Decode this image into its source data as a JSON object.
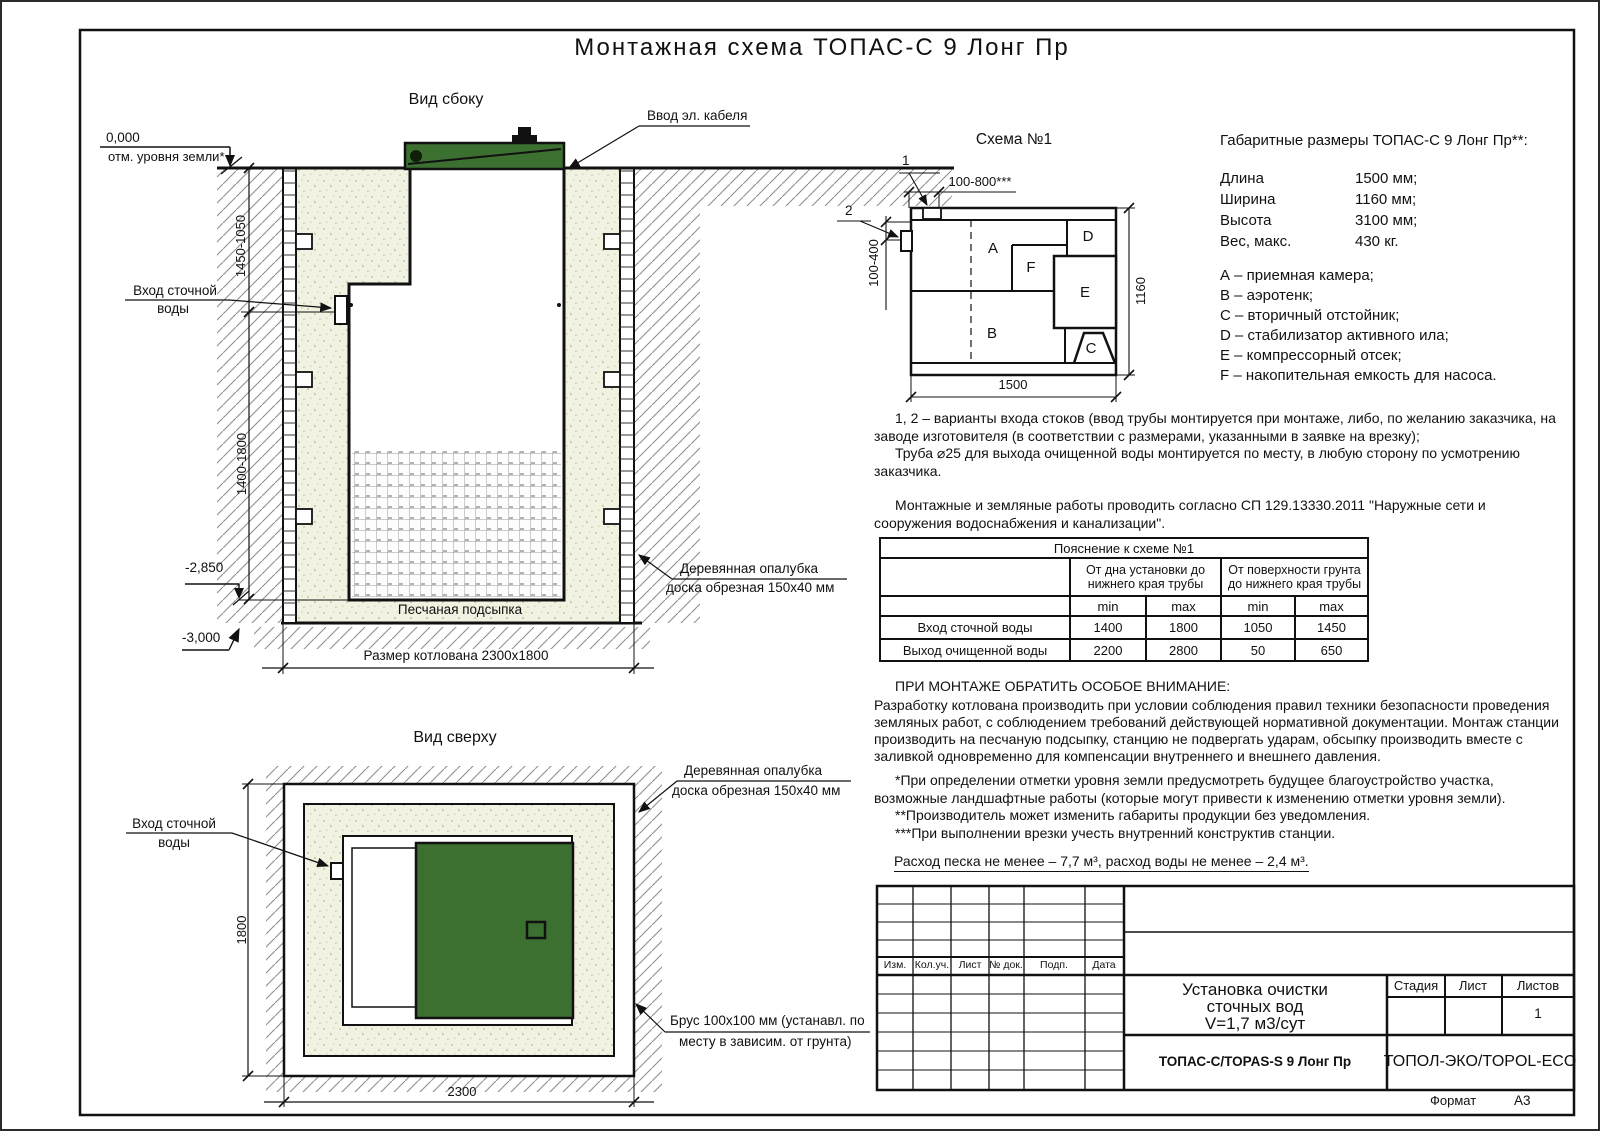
{
  "page": {
    "title": "Монтажная схема ТОПАС-С 9 Лонг Пр",
    "format_label": "Формат",
    "format_value": "А3"
  },
  "side_view": {
    "title": "Вид сбоку",
    "elev_zero": "0,000",
    "ground_note": "отм. уровня земли*",
    "cable_label": "Ввод эл. кабеля",
    "inlet_label_1": "Вход сточной",
    "inlet_label_2": "воды",
    "dim_upper": "1450-1050",
    "dim_lower": "1400-1800",
    "elev_2850": "-2,850",
    "elev_3000": "-3,000",
    "formwork_1": "Деревянная опалубка",
    "formwork_2": "доска обрезная 150х40 мм",
    "sand_label": "Песчаная подсыпка",
    "pit_dim": "Размер котлована 2300х1800"
  },
  "schema": {
    "title": "Схема №1",
    "marker_1": "1",
    "marker_2": "2",
    "dim_top": "100-800***",
    "dim_left": "100-400",
    "dim_right": "1160",
    "dim_bottom": "1500",
    "comp_a": "A",
    "comp_b": "B",
    "comp_c": "C",
    "comp_d": "D",
    "comp_e": "E",
    "comp_f": "F"
  },
  "dims": {
    "title": "Габаритные размеры ТОПАС-С 9 Лонг Пр**:",
    "rows": [
      {
        "label": "Длина",
        "value": "1500 мм;"
      },
      {
        "label": "Ширина",
        "value": "1160 мм;"
      },
      {
        "label": "Высота",
        "value": "3100 мм;"
      },
      {
        "label": "Вес, макс.",
        "value": "430 кг."
      }
    ],
    "legend": [
      "А – приемная камера;",
      "В – аэротенк;",
      "С – вторичный отстойник;",
      "D – стабилизатор активного ила;",
      "Е – компрессорный отсек;",
      "F – накопительная емкость для насоса."
    ]
  },
  "notes": {
    "p1": "1, 2 – варианты входа  стоков (ввод трубы монтируется при монтаже, либо, по желанию заказчика, на заводе изготовителя (в соответствии с размерами, указанными в заявке на врезку);",
    "p2": "Труба ⌀25 для выхода очищенной воды монтируется по месту, в любую сторону по усмотрению заказчика.",
    "p3": "Монтажные и земляные работы проводить согласно СП 129.13330.2011 \"Наружные сети и сооружения водоснабжения и канализации\"."
  },
  "table": {
    "title": "Пояснение к схеме №1",
    "group_1a": "От дна установки до",
    "group_1b": "нижнего края трубы",
    "group_2a": "От поверхности грунта",
    "group_2b": "до нижнего края трубы",
    "min1": "min",
    "max1": "max",
    "min2": "min",
    "max2": "max",
    "row_1_label": "Вход сточной воды",
    "row_1": [
      "1400",
      "1800",
      "1050",
      "1450"
    ],
    "row_2_label": "Выход очищенной воды",
    "row_2": [
      "2200",
      "2800",
      "50",
      "650"
    ]
  },
  "attention": {
    "title": "ПРИ МОНТАЖЕ ОБРАТИТЬ ОСОБОЕ ВНИМАНИЕ:",
    "body": "Разработку котлована производить при условии соблюдения правил техники безопасности проведения земляных работ, с соблюдением требований действующей нормативной документации. Монтаж станции производить на песчаную подсыпку, станцию не подвергать ударам, обсыпку производить вместе с заливкой одновременно для компенсации внутреннего и внешнего давления.",
    "fn1": "*При определении отметки уровня земли предусмотреть будущее благоустройство участка, возможные ландшафтные работы (которые могут привести к изменению отметки уровня земли).",
    "fn2": "**Производитель может изменить габариты продукции без уведомления.",
    "fn3": "***При выполнении врезки учесть внутренний конструктив станции.",
    "consumption": "Расход песка не менее – 7,7 м³, расход воды не менее – 2,4 м³."
  },
  "top_view": {
    "title": "Вид сверху",
    "inlet_label_1": "Вход сточной",
    "inlet_label_2": "воды",
    "formwork_1": "Деревянная опалубка",
    "formwork_2": "доска обрезная 150х40 мм",
    "beam_1": "Брус 100х100 мм (устанавл. по",
    "beam_2": "месту в зависим. от грунта)",
    "dim_height": "1800",
    "dim_width": "2300"
  },
  "title_block": {
    "rev_headers": [
      "Изм.",
      "Кол.уч.",
      "Лист",
      "№ док.",
      "Подп.",
      "Дата"
    ],
    "doc_title_1": "Установка очистки",
    "doc_title_2": "сточных вод",
    "doc_title_3": "V=1,7 м3/сут",
    "stage": "Стадия",
    "sheet": "Лист",
    "sheets": "Листов",
    "sheets_value": "1",
    "model": "ТОПАС-С/TOPAS-S 9 Лонг Пр",
    "company": "ТОПОЛ-ЭКО/TOPOL-ECO"
  },
  "colors": {
    "lid_green": "#3c7030",
    "sand_base": "#f2f2e2",
    "line": "#111111"
  }
}
